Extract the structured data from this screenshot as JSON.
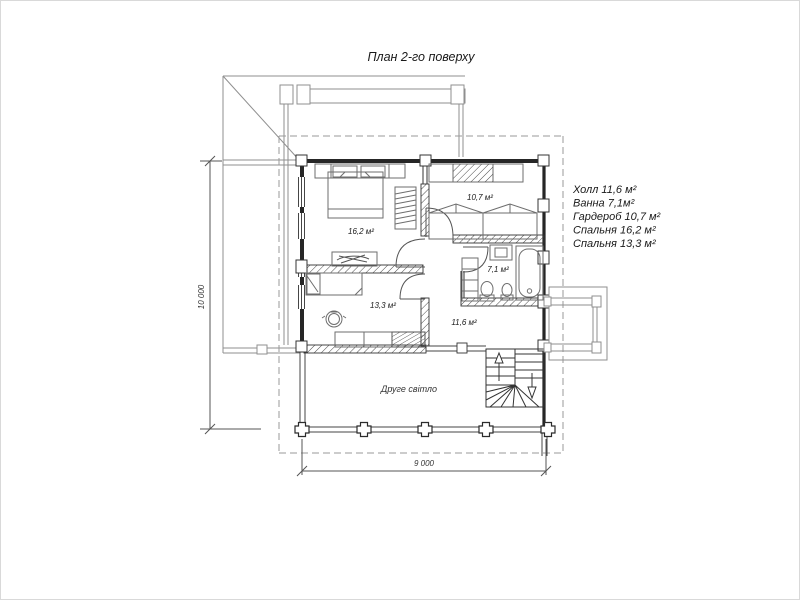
{
  "title": "План 2-го поверху",
  "legend": {
    "items": [
      "Холл 11,6 м²",
      "Ванна 7,1м²",
      "Гардероб 10,7 м²",
      "Спальня 16,2 м²",
      "Спальня 13,3 м²"
    ]
  },
  "rooms": {
    "bedroom_large": "16,2 м²",
    "wardrobe": "10,7 м²",
    "bathroom": "7,1 м²",
    "bedroom_small": "13,3 м²",
    "hall": "11,6 м²"
  },
  "annotations": {
    "second_light": "Друге світло"
  },
  "dimensions": {
    "bottom_width": "9 000",
    "left_height": "10 000"
  },
  "colors": {
    "wall": "#262626",
    "thin_line": "#8f8f8f",
    "furniture_line": "#6e6e6e",
    "dashed_line": "#9a9a9a",
    "text": "#1a1a1a"
  }
}
